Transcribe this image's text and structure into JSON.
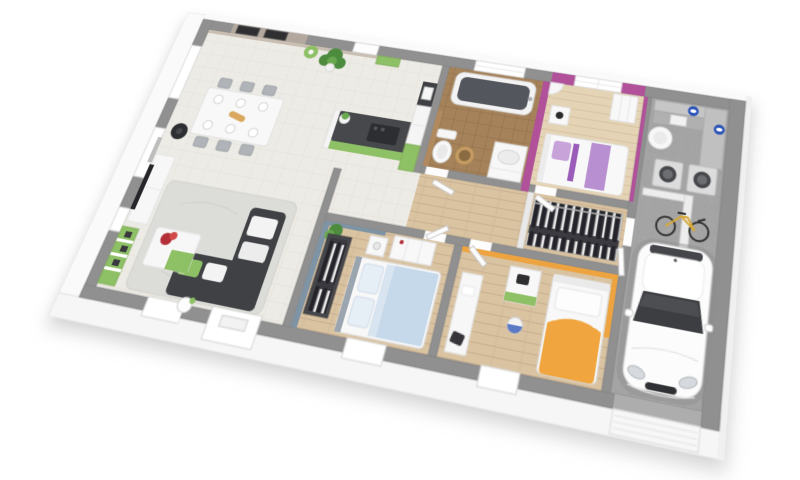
{
  "scene": {
    "title": "3D floor plan rendering of a single-storey house with garage",
    "style": "isometric-architectural-render",
    "background_color": "#ffffff"
  },
  "colors": {
    "wall_top": "#909090",
    "wall_face": "#fafafa",
    "floor_tile": "#edebe5",
    "floor_wood": "#d9c3a1",
    "floor_wood_light": "#e4d3b5",
    "floor_bath": "#a5825a",
    "floor_concrete": "#a4a4a4",
    "magenta_wall": "#b0519a",
    "lavender_bed": "#b88fd0",
    "lavender_pillow": "#c7a3da",
    "blue_wall": "#7e93a4",
    "blue_bed": "#c6d9eb",
    "blue_pillow": "#e6eef6",
    "orange_wall": "#eda33f",
    "orange_bed": "#f0a53f",
    "green_accent": "#8ec065",
    "charcoal": "#3f4144",
    "dark_counter": "#46484c",
    "taupe_wall": "#b3a89d",
    "tan_wc_wall": "#b08a5e",
    "basket_tan": "#c49b63",
    "red_flowers": "#b33039",
    "bike_yellow": "#d8a93c",
    "logo_blue": "#2c53b8",
    "car_white": "#fcfcfc",
    "glass_dark": "#3c3e42",
    "rug_gray": "#dcdcd8",
    "plant_green": "#4d8c3f",
    "plant_green_light": "#69a84f"
  },
  "rooms": [
    {
      "name": "living-dining-room",
      "floor": "tile",
      "furniture": [
        "corner-sofa",
        "coffee-table",
        "rug",
        "tv-unit",
        "wall-tv",
        "green-wall-shelf",
        "wood-stove",
        "dining-table",
        "chairs-x6",
        "floor-lamp",
        "ball-lamp",
        "palm-plant",
        "wall-art-frames",
        "front-door"
      ]
    },
    {
      "name": "kitchen",
      "floor": "tile",
      "furniture": [
        "breakfast-bar",
        "hob",
        "bar-plant",
        "tall-cabinet",
        "fridge",
        "green-cabinets"
      ]
    },
    {
      "name": "bathroom-wc",
      "floor": "brown-tile",
      "furniture": [
        "bathtub",
        "vanity-sink",
        "toilet",
        "laundry-basket",
        "window"
      ]
    },
    {
      "name": "bedroom-purple",
      "floor": "light-wood",
      "furniture": [
        "single-bed",
        "nightstand",
        "lamp",
        "corner-shelf",
        "dresser",
        "window"
      ]
    },
    {
      "name": "hallway-dressing",
      "floor": "wood",
      "furniture": [
        "hanging-clothes-rail",
        "interior-doors"
      ]
    },
    {
      "name": "bedroom-blue",
      "floor": "wood",
      "furniture": [
        "double-bed",
        "open-wardrobe",
        "dresser",
        "nightstand",
        "plant"
      ]
    },
    {
      "name": "bedroom-orange",
      "floor": "wood",
      "furniture": [
        "single-bed",
        "green-nightstand",
        "desk",
        "toy-ball"
      ]
    },
    {
      "name": "garage-utility",
      "floor": "concrete",
      "furniture": [
        "car",
        "bicycle",
        "washing-machines-x2",
        "water-heater",
        "utility-counter",
        "detergent-logos",
        "garage-door"
      ]
    }
  ]
}
